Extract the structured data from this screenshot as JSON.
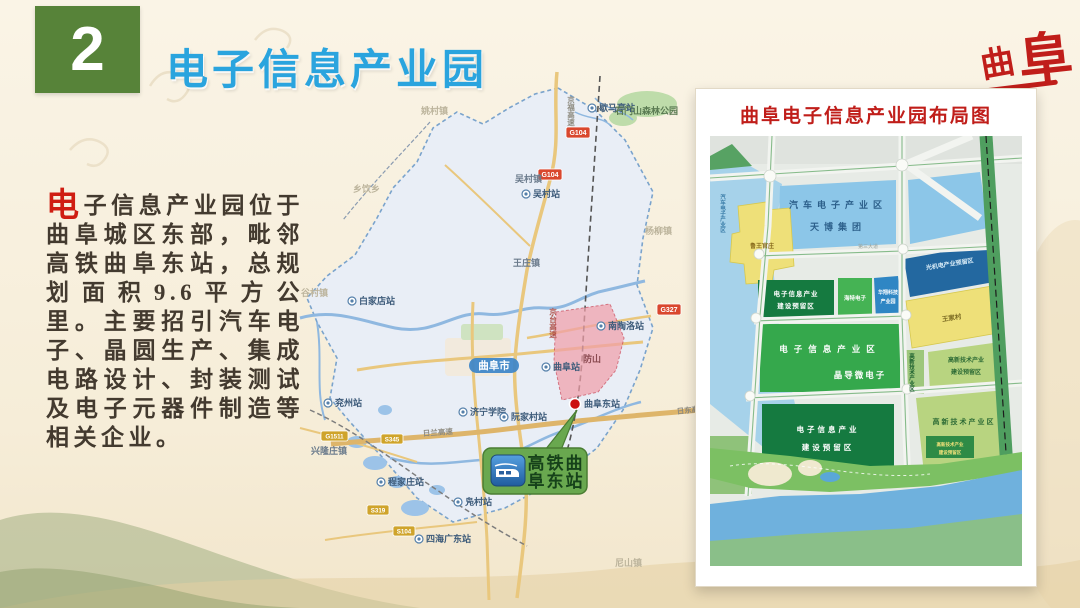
{
  "slide": {
    "number": "2",
    "title": "电子信息产业园",
    "corner_logo_char1": "曲",
    "corner_logo_char2": "阜",
    "accent_green": "#578339",
    "title_blue": "#2aa4de",
    "accent_red": "#c01e1a"
  },
  "intro": {
    "drop_cap": "电",
    "body": "子信息产业园位于曲阜城区东部，毗邻高铁曲阜东站，总规划面积9.6平方公里。主要招引汽车电子、晶圆生产、集成电路设计、封装测试及电子元器件制造等相关企业。"
  },
  "city_map": {
    "city_badge": "曲阜市",
    "pink_zone_label": "防山",
    "callout": {
      "line1": "高铁曲",
      "line2": "阜东站"
    },
    "labels": {
      "xiemating": "歇马亭站",
      "shimenshan": "石门山森林公园",
      "yaocun": "姚村镇",
      "wucunzhen": "吴村镇",
      "wucunzhan": "吴村站",
      "xiangyin": "乡饮乡",
      "wangzhuang": "王庄镇",
      "baijiadian": "白家店站",
      "gucun": "谷村镇",
      "yangliu": "杨柳镇",
      "nantaoluo": "南陶洛站",
      "qufuzhan": "曲阜站",
      "qufudong": "曲阜东站",
      "jiningxueyuan": "济宁学院",
      "ruanjiacun": "阮家村站",
      "yanzhou": "兖州站",
      "xinglongzhuang": "兴隆庄镇",
      "chengjiazhuang": "程家庄站",
      "fucun": "凫村站",
      "guangchezhan": "四海广东站",
      "nishan": "尼山镇"
    },
    "roads": {
      "rilan": "日兰高速",
      "ridong": "日东高速",
      "jingfu": "京福高速",
      "jingtai": "京台高速"
    },
    "badges": {
      "g104a": "G104",
      "g104b": "G104",
      "g327": "G327",
      "g1511": "G1511",
      "s345": "S345",
      "s319": "S319",
      "s104": "S104"
    }
  },
  "layout_panel": {
    "title": "曲阜电子信息产业园布局图",
    "areas": {
      "auto_zone": "汽车电子产业区",
      "tianbo": "天博集团",
      "auto_zone_vertical": "汽车电子产业区",
      "village_west": "鲁王官庄",
      "einfo_reserve_l1": "电子信息产业",
      "einfo_reserve_l2": "建设预留区",
      "haite": "海特电子",
      "tech_park_l1": "华翔科技",
      "tech_park_l2": "产业园",
      "optomech": "光机电产业预留区",
      "wangjiacun": "王家村",
      "einfo_zone": "电子信息产业区",
      "jingdaowei": "晶导微电子",
      "hitech_vertical": "高新技术产业区",
      "hitech_reserve_l1": "高新技术产业",
      "hitech_reserve_l2": "建设预留区",
      "einfo_reserve_b1": "电子信息产业",
      "einfo_reserve_b2": "建设预留区",
      "hitech_zone": "高新技术产业区",
      "hitech_small_l1": "高新技术产业",
      "hitech_small_l2": "建设预留区",
      "road_label": "第三大道"
    }
  }
}
